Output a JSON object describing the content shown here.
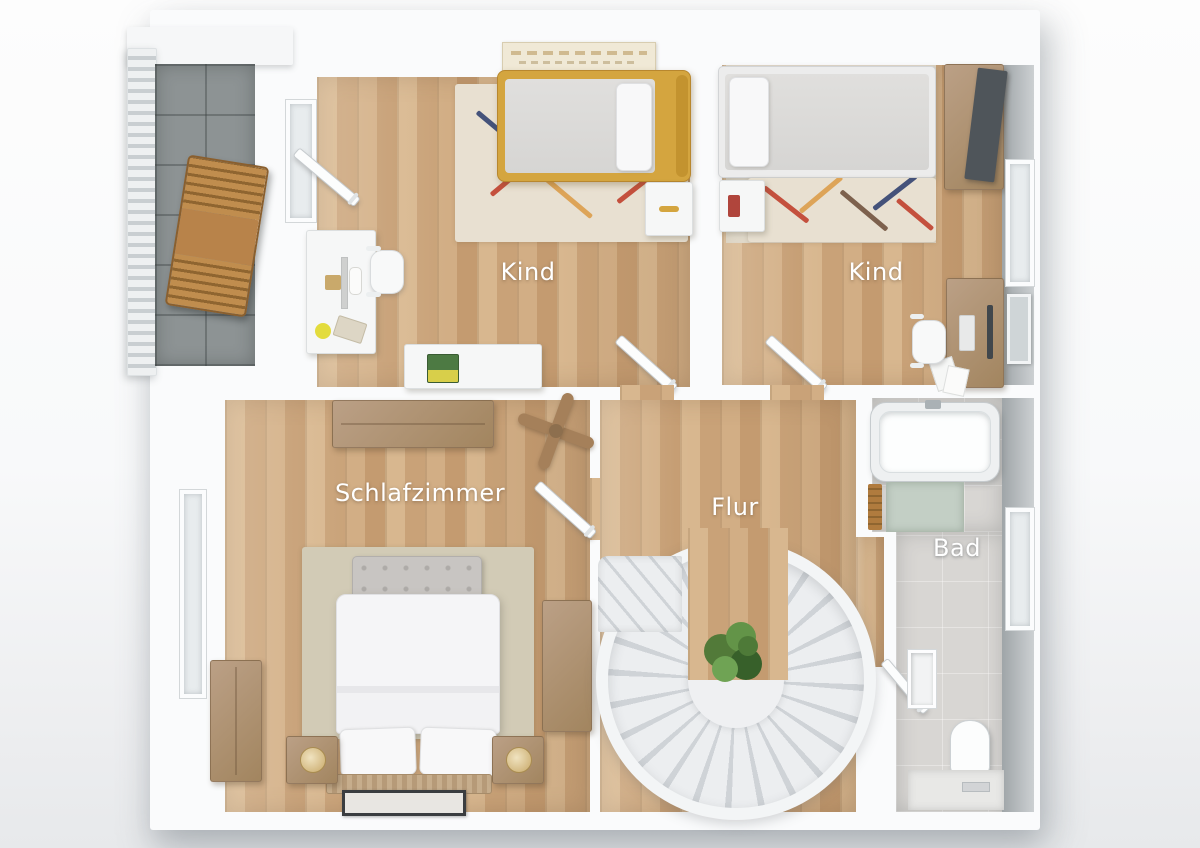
{
  "rooms": {
    "kind1": {
      "label": "Kind"
    },
    "kind2": {
      "label": "Kind"
    },
    "schlafzimmer": {
      "label": "Schlafzimmer"
    },
    "flur": {
      "label": "Flur"
    },
    "bad": {
      "label": "Bad"
    }
  },
  "colors": {
    "wood_floor": "#cfac84",
    "accent_mustard": "#d4a53f",
    "balcony_tile": "#8d9394",
    "wall_white": "#fafbfc",
    "rug_cream": "#e8e0d1",
    "bedroom_rug_beige": "#d2cbb6",
    "plant_green": "#527a39",
    "bath_floor_gray": "#d8d6d3",
    "stair_step_gray": "#cfd3d7",
    "label_text": "#ffffff"
  }
}
